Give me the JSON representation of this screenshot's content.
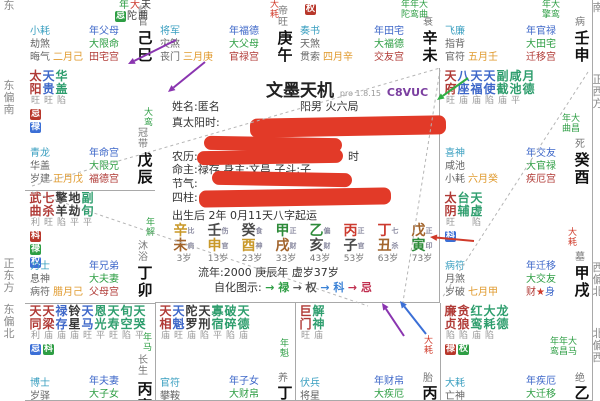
{
  "app": {
    "title": "文墨天机",
    "version": "pro 1.8.15",
    "code": "C8VUC"
  },
  "center": {
    "title": "文墨天机",
    "version": "pro 1.8.15",
    "code": "C8VUC",
    "name_line": {
      "label": "姓名:",
      "value": "匿名",
      "right": "阳男 火六局"
    },
    "rows": [
      {
        "y": 116,
        "label": "真太阳时:",
        "redacted": true
      },
      {
        "y": 136,
        "label": "",
        "redacted": true
      },
      {
        "y": 150,
        "label": "农历:",
        "suffix": "时",
        "redacted": true
      },
      {
        "y": 163,
        "text": "命主:禄存 身主:文昌 子斗:子"
      },
      {
        "y": 177,
        "label": "节气:",
        "redacted": true
      },
      {
        "y": 191,
        "label": "四柱:",
        "redacted": true
      },
      {
        "y": 209,
        "text": "出生后 2年 0月11天八字起运"
      }
    ],
    "dayun": {
      "stems": [
        "辛",
        "壬",
        "癸",
        "甲",
        "乙",
        "丙",
        "丁",
        "戊"
      ],
      "branches": [
        "未",
        "申",
        "酉",
        "戌",
        "亥",
        "子",
        "丑",
        "寅"
      ],
      "stem_elems": [
        "metal",
        "water",
        "water",
        "wood",
        "wood",
        "fire",
        "fire",
        "earth"
      ],
      "branch_elems": [
        "earth",
        "metal",
        "metal",
        "earth",
        "water",
        "water",
        "earth",
        "wood"
      ],
      "gods": [
        "比肩",
        "伤官",
        "食神",
        "正财",
        "偏财",
        "正官",
        "七杀",
        "正印"
      ],
      "ages": [
        "3岁",
        "13岁",
        "23岁",
        "33岁",
        "43岁",
        "53岁",
        "63岁",
        "73岁"
      ]
    },
    "liunian": "流年:2000 庚辰年 虚岁37岁",
    "zihua": {
      "label": "自化图示:",
      "items": [
        {
          "t": "→ 禄",
          "c": "#2e9e44"
        },
        {
          "t": "→ 权",
          "c": "#555555"
        },
        {
          "t": "→ 科",
          "c": "#3b82d6"
        },
        {
          "t": "→ 忌",
          "c": "#c03050"
        }
      ]
    }
  },
  "element_colors": {
    "metal": "#c9992a",
    "water": "#4a4a4a",
    "wood": "#2e8b3a",
    "fire": "#cc3b2f",
    "earth": "#a2642c"
  },
  "compass": {
    "left": [
      {
        "t": "东",
        "y": 0
      },
      {
        "t": "东偏南",
        "y": 80
      },
      {
        "t": "正东方",
        "y": 258
      },
      {
        "t": "东偏北",
        "y": 304
      }
    ],
    "right": [
      {
        "t": "南",
        "y": 2
      },
      {
        "t": "正西方",
        "y": 74
      },
      {
        "t": "西偏北",
        "y": 262
      },
      {
        "t": "北偏西",
        "y": 328
      }
    ]
  },
  "palaces": [
    {
      "branch": "巳",
      "row": 0,
      "col": 0,
      "frag": [
        {
          "x": 94,
          "y": 0,
          "items": [
            {
              "t": "年",
              "c": "fgr"
            },
            {
              "t": "大",
              "c": "fre"
            },
            {
              "t": "天",
              "c": "fd"
            }
          ]
        },
        {
          "x": 90,
          "y": 11,
          "items": [
            {
              "t": "忌",
              "badge": "dec"
            },
            {
              "t": "陀",
              "c": "fd"
            },
            {
              "t": "曲",
              "c": "fd"
            }
          ]
        }
      ],
      "bl": [
        "小耗",
        "劫煞",
        "晦气"
      ],
      "month": "二月己",
      "brr": [
        [
          "年父母",
          "yr"
        ],
        [
          "大限命",
          "dec"
        ],
        [
          "田宅宫",
          "natal"
        ]
      ],
      "stage": "临官",
      "ganzhi": "己巳"
    },
    {
      "branch": "午",
      "row": 0,
      "col": 1,
      "flow": [
        {
          "x": 114,
          "y": 0,
          "t": "大耗",
          "c": "fr",
          "v": 1
        }
      ],
      "bl": [
        "将军",
        "灾煞",
        "丧门"
      ],
      "month": "三月庚",
      "brr": [
        [
          "年福德",
          "yr"
        ],
        [
          "大父母",
          "dec"
        ],
        [
          "官禄宫",
          "natal"
        ]
      ],
      "stage": "帝旺",
      "ganzhi": "庚午"
    },
    {
      "branch": "未",
      "row": 0,
      "col": 2,
      "float_badges": [
        {
          "x": 10,
          "y": 2,
          "t": "权",
          "k": "born"
        }
      ],
      "flow": [
        {
          "x": 106,
          "y": 0,
          "t": "年年大",
          "c": "fg"
        },
        {
          "x": 106,
          "y": 10,
          "t": "陀鸾曲",
          "c": "fg"
        }
      ],
      "bl": [
        "奏书",
        "天煞",
        "贯索"
      ],
      "month": "四月辛",
      "brr": [
        [
          "年田宅",
          "yr"
        ],
        [
          "大福德",
          "dec"
        ],
        [
          "交友宫",
          "natal"
        ]
      ],
      "stage": "衰",
      "ganzhi": "辛未"
    },
    {
      "branch": "申",
      "row": 0,
      "col": 3,
      "flow": [
        {
          "x": 102,
          "y": 0,
          "t": "年大",
          "c": "fg"
        },
        {
          "x": 102,
          "y": 10,
          "t": "擎鸾",
          "c": "fg"
        }
      ],
      "bl": [
        "飞廉",
        "指背",
        "官符"
      ],
      "month": "五月壬",
      "brr": [
        [
          "年官禄",
          "yr"
        ],
        [
          "大田宅",
          "dec"
        ],
        [
          "迁移宫",
          "natal"
        ]
      ],
      "stage": "病",
      "ganzhi": "壬申"
    },
    {
      "branch": "酉",
      "row": 1,
      "col": 3,
      "stars": [
        {
          "n": "天府",
          "b": "旺",
          "c": "main"
        },
        {
          "n": "八座",
          "b": "庙",
          "c": "lucky"
        },
        {
          "n": "天福",
          "b": "庙",
          "c": "lucky"
        },
        {
          "n": "天使",
          "b": "陷",
          "c": "lucky"
        },
        {
          "n": "副截",
          "b": "庙",
          "c": "misc"
        },
        {
          "n": "咸池",
          "b": "平",
          "c": "misc"
        },
        {
          "n": "月德",
          "b": "",
          "c": "misc"
        }
      ],
      "flow": [
        {
          "x": 122,
          "y": 46,
          "t": "年大",
          "c": "fg"
        },
        {
          "x": 122,
          "y": 56,
          "t": "曲昌",
          "c": "fg"
        }
      ],
      "bl": [
        "喜神",
        "咸池",
        "小耗"
      ],
      "month": "六月癸",
      "brr": [
        [
          "年交友",
          "yr"
        ],
        [
          "大官禄",
          "dec"
        ],
        [
          "疾厄宫",
          "natal"
        ]
      ],
      "stage": "死",
      "ganzhi": "癸酉"
    },
    {
      "branch": "戌",
      "row": 2,
      "col": 3,
      "stars": [
        {
          "n": "太阴",
          "b": "旺",
          "c": "main",
          "t": [
            [
              "科",
              "yr"
            ]
          ]
        },
        {
          "n": "台辅",
          "b": "",
          "c": "misc"
        },
        {
          "n": "天虚",
          "b": "陷",
          "c": "misc"
        }
      ],
      "flow": [
        {
          "x": 127,
          "y": 38,
          "t": "大耗",
          "c": "fr",
          "v": 1
        }
      ],
      "bl": [
        "病符",
        "月煞",
        "岁破"
      ],
      "month": "七月甲",
      "brr": [
        [
          "年迁移",
          "yr"
        ],
        [
          "大交友",
          "dec"
        ],
        [
          "财★身",
          "body"
        ]
      ],
      "stage": "墓",
      "ganzhi": "甲戌"
    },
    {
      "branch": "亥",
      "row": 3,
      "col": 3,
      "stars": [
        {
          "n": "廉贞",
          "b": "陷",
          "c": "main",
          "t": [
            [
              "禄",
              "born"
            ]
          ]
        },
        {
          "n": "贪狼",
          "b": "陷",
          "c": "main",
          "t": [
            [
              "权",
              "dec"
            ]
          ]
        },
        {
          "n": "红鸾",
          "b": "庙",
          "c": "misc"
        },
        {
          "n": "大耗",
          "b": "陷",
          "c": "misc"
        },
        {
          "n": "龙德",
          "b": "",
          "c": "misc"
        }
      ],
      "flow": [
        {
          "x": 110,
          "y": 34,
          "t": "年年大",
          "c": "fg"
        },
        {
          "x": 110,
          "y": 44,
          "t": "鸾昌马",
          "c": "fg"
        }
      ],
      "bl": [
        "大耗",
        "亡神"
      ],
      "brr": [
        [
          "年疾厄",
          "yr"
        ],
        [
          "大迁移",
          "dec"
        ]
      ],
      "stage": "绝",
      "ganzhi": "乙亥",
      "ey": [
        70,
        82
      ],
      "blY": 74
    },
    {
      "branch": "子",
      "row": 3,
      "col": 2,
      "stars": [
        {
          "n": "巨门",
          "b": "旺",
          "c": "main"
        },
        {
          "n": "解神",
          "b": "庙",
          "c": "misc"
        }
      ],
      "flow": [
        {
          "x": 128,
          "y": 33,
          "t": "大耗",
          "c": "fr",
          "v": 1
        }
      ],
      "bl": [
        "伏兵",
        "将星"
      ],
      "brr": [
        [
          "年财帛",
          "yr"
        ],
        [
          "大疾厄",
          "dec"
        ]
      ],
      "stage": "胎",
      "ganzhi": "丙子",
      "ey": [
        70,
        82
      ],
      "blY": 74
    },
    {
      "branch": "丑",
      "row": 3,
      "col": 1,
      "stars": [
        {
          "n": "天相",
          "b": "庙",
          "c": "main"
        },
        {
          "n": "天魁",
          "b": "旺",
          "c": "lucky"
        },
        {
          "n": "陀罗",
          "b": "庙",
          "c": "bad"
        },
        {
          "n": "天刑",
          "b": "陷",
          "c": "bad"
        },
        {
          "n": "寡宿",
          "b": "平",
          "c": "misc"
        },
        {
          "n": "破碎",
          "b": "陷",
          "c": "misc"
        },
        {
          "n": "天德",
          "b": "庙",
          "c": "misc"
        }
      ],
      "flow": [
        {
          "x": 124,
          "y": 36,
          "t": "年魁",
          "c": "fg",
          "v": 1
        }
      ],
      "bl": [
        "官符",
        "攀鞍"
      ],
      "brr": [
        [
          "年子女",
          "yr"
        ],
        [
          "大财帛",
          "dec"
        ]
      ],
      "stage": "养",
      "ganzhi": "丁丑",
      "ey": [
        70,
        82
      ],
      "blY": 74
    },
    {
      "branch": "寅",
      "row": 3,
      "col": 0,
      "stars": [
        {
          "n": "天同",
          "b": "利",
          "c": "main",
          "t": [
            [
              "忌",
              "yr"
            ]
          ]
        },
        {
          "n": "天梁",
          "b": "庙",
          "c": "main",
          "t": [
            [
              "科",
              "dec"
            ]
          ]
        },
        {
          "n": "禄存",
          "b": "庙",
          "c": "lucky"
        },
        {
          "n": "铃星",
          "b": "庙",
          "c": "bad"
        },
        {
          "n": "天马",
          "b": "旺",
          "c": "lucky"
        },
        {
          "n": "恩光",
          "b": "平",
          "c": "misc"
        },
        {
          "n": "天寿",
          "b": "旺",
          "c": "misc"
        },
        {
          "n": "旬空",
          "b": "陷",
          "c": "misc"
        },
        {
          "n": "天哭",
          "b": "平",
          "c": "misc"
        }
      ],
      "flow": [
        {
          "x": 117,
          "y": 30,
          "t": "年马",
          "c": "fg",
          "v": 1
        }
      ],
      "bl": [
        "博士",
        "岁驿"
      ],
      "brr": [
        [
          "年夫妻",
          "yr"
        ],
        [
          "大子女",
          "dec"
        ]
      ],
      "stage": "长生",
      "ganzhi": "丙寅",
      "ey": [
        52,
        78
      ],
      "blY": 74
    },
    {
      "branch": "卯",
      "row": 2,
      "col": 0,
      "stars": [
        {
          "n": "武曲",
          "b": "利",
          "c": "main",
          "t": [
            [
              "科",
              "born"
            ],
            [
              "禄",
              "dec"
            ],
            [
              "权",
              "yr"
            ]
          ]
        },
        {
          "n": "七杀",
          "b": "旺",
          "c": "main"
        },
        {
          "n": "擎羊",
          "b": "陷",
          "c": "bad"
        },
        {
          "n": "地劫",
          "b": "平",
          "c": "bad"
        },
        {
          "n": "副旬",
          "b": "平",
          "c": "misc"
        }
      ],
      "flow": [
        {
          "x": 120,
          "y": 28,
          "t": "年解",
          "c": "fg",
          "v": 1
        }
      ],
      "bl": [
        "力士",
        "息神",
        "病符"
      ],
      "month": "腊月己",
      "brr": [
        [
          "年兄弟",
          "yr"
        ],
        [
          "大夫妻",
          "dec"
        ],
        [
          "父母宫",
          "natal"
        ]
      ],
      "stage": "沐浴",
      "ganzhi": "丁卯"
    },
    {
      "branch": "辰",
      "row": 1,
      "col": 0,
      "stars": [
        {
          "n": "太阳",
          "b": "旺",
          "c": "main",
          "t": [
            [
              "忌",
              "born"
            ],
            [
              "禄",
              "yr"
            ]
          ]
        },
        {
          "n": "天贵",
          "b": "旺",
          "c": "lucky"
        },
        {
          "n": "华盖",
          "b": "陷",
          "c": "misc"
        }
      ],
      "flow": [
        {
          "x": 118,
          "y": 40,
          "t": "大鸾",
          "c": "fg",
          "v": 1
        }
      ],
      "bl": [
        "青龙",
        "华盖",
        "岁建"
      ],
      "month": "正月戊",
      "brr": [
        [
          "年命宫",
          "yr"
        ],
        [
          "大限兄",
          "dec"
        ],
        [
          "福德宫",
          "natal"
        ]
      ],
      "stage": "冠带",
      "ganzhi": "戊辰"
    }
  ],
  "redactions": [
    {
      "x": 250,
      "y": 117,
      "w": 196,
      "h": 19,
      "r": -1
    },
    {
      "x": 204,
      "y": 137,
      "w": 138,
      "h": 14,
      "r": 1
    },
    {
      "x": 197,
      "y": 150,
      "w": 146,
      "h": 14,
      "r": -1
    },
    {
      "x": 212,
      "y": 172,
      "w": 140,
      "h": 14,
      "r": 1
    },
    {
      "x": 199,
      "y": 189,
      "w": 192,
      "h": 17,
      "r": -1
    }
  ],
  "annotations": {
    "dashed": [
      [
        32,
        186,
        440,
        68
      ],
      [
        32,
        192,
        368,
        306
      ],
      [
        440,
        70,
        402,
        308
      ],
      [
        588,
        72,
        442,
        298
      ]
    ],
    "arrows": [
      {
        "x1": 176,
        "y1": 40,
        "x2": 128,
        "y2": 64,
        "c": "#8a35b0"
      },
      {
        "x1": 205,
        "y1": 62,
        "x2": 168,
        "y2": 92,
        "c": "#8a35b0"
      },
      {
        "x1": 468,
        "y1": 78,
        "x2": 437,
        "y2": 100,
        "c": "#2fae44"
      },
      {
        "x1": 474,
        "y1": 241,
        "x2": 430,
        "y2": 237,
        "c": "#d03a2a"
      },
      {
        "x1": 404,
        "y1": 336,
        "x2": 382,
        "y2": 303,
        "c": "#8a35b0"
      },
      {
        "x1": 426,
        "y1": 334,
        "x2": 400,
        "y2": 301,
        "c": "#3b6fd6"
      }
    ]
  }
}
